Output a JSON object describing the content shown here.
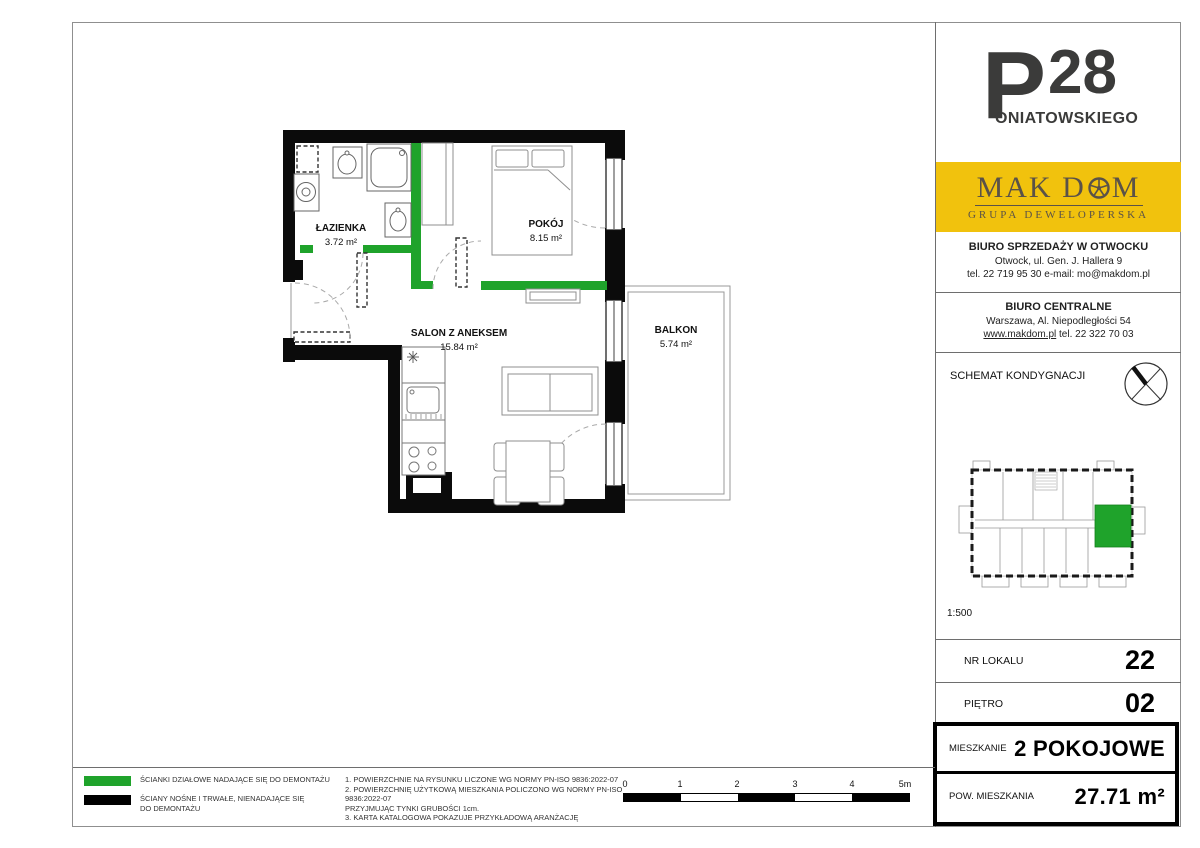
{
  "colors": {
    "partition_green": "#1FA32B",
    "wall_black": "#0B0B0B",
    "brand_yellow": "#F1C20D",
    "logo_gray": "#3B3B3A"
  },
  "logo": {
    "initial": "P",
    "number": "28",
    "name_rest": "ONIATOWSKIEGO"
  },
  "brand": {
    "wordmark_pre": "MAK D",
    "wordmark_post": "M",
    "subtitle": "GRUPA DEWELOPERSKA"
  },
  "offices": [
    {
      "title": "BIURO SPRZEDAŻY W OTWOCKU",
      "line1": "Otwock, ul. Gen. J. Hallera 9",
      "line2": "tel. 22 719 95 30   e-mail: mo@makdom.pl"
    },
    {
      "title": "BIURO CENTRALNE",
      "line1": "Warszawa, Al. Niepodległości 54",
      "link": "www.makdom.pl",
      "line2": " tel. 22 322 70 03"
    }
  ],
  "floor_schematic": {
    "title": "SCHEMAT KONDYGNACJI",
    "scale": "1:500"
  },
  "unit": {
    "rows": [
      {
        "label": "NR LOKALU",
        "value": "22"
      },
      {
        "label": "PIĘTRO",
        "value": "02"
      }
    ],
    "highlight_rows": [
      {
        "label": "MIESZKANIE",
        "value": "2 POKOJOWE"
      },
      {
        "label": "POW. MIESZKANIA",
        "value": "27.71 m²"
      }
    ]
  },
  "plan": {
    "rooms": [
      {
        "name": "ŁAZIENKA",
        "area": "3.72 m²"
      },
      {
        "name": "POKÓJ",
        "area": "8.15 m²"
      },
      {
        "name": "SALON Z ANEKSEM",
        "area": "15.84 m²"
      },
      {
        "name": "BALKON",
        "area": "5.74 m²"
      }
    ]
  },
  "legend": {
    "items": [
      {
        "color": "#1FA32B",
        "lines": [
          "ŚCIANKI DZIAŁOWE NADAJĄCE SIĘ DO DEMONTAŻU",
          ""
        ]
      },
      {
        "color": "#000000",
        "lines": [
          "ŚCIANY NOŚNE I TRWAŁE, NIENADAJĄCE SIĘ",
          "DO DEMONTAŻU"
        ]
      }
    ]
  },
  "notes": [
    "1. POWIERZCHNIE NA RYSUNKU LICZONE WG NORMY PN-ISO 9836:2022-07",
    "2. POWIERZCHNIĘ UŻYTKOWĄ MIESZKANIA POLICZONO WG NORMY PN-ISO 9836:2022-07",
    "PRZYJMUJĄC TYNKI GRUBOŚCI 1cm.",
    "3. KARTA KATALOGOWA POKAZUJE PRZYKŁADOWĄ ARANŻACJĘ"
  ],
  "scale_bar": {
    "labels": [
      "0",
      "1",
      "2",
      "3",
      "4",
      "5m"
    ]
  }
}
